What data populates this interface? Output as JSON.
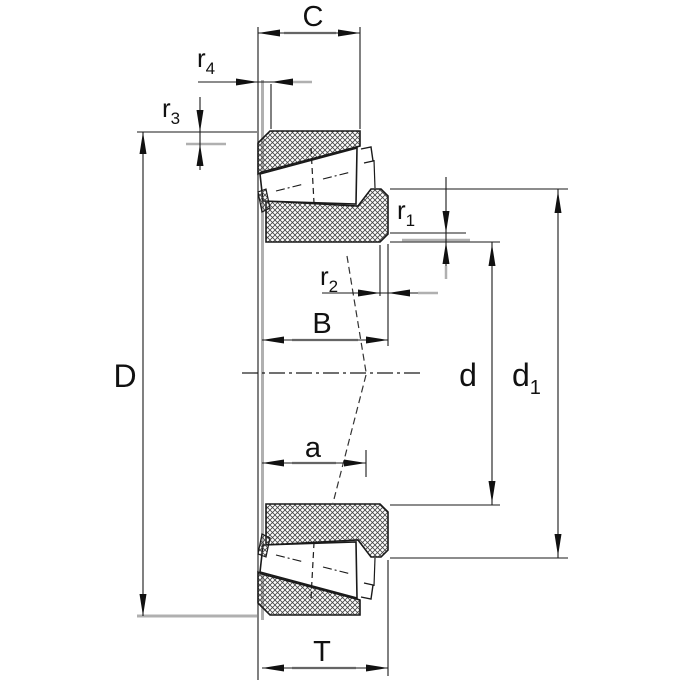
{
  "drawing": {
    "kind": "tapered-roller-bearing-dimension-drawing",
    "labels": {
      "C": "C",
      "D": "D",
      "B": "B",
      "T": "T",
      "a": "a",
      "d": "d",
      "d1": {
        "base": "d",
        "sub": "1"
      },
      "r1": {
        "base": "r",
        "sub": "1"
      },
      "r2": {
        "base": "r",
        "sub": "2"
      },
      "r3": {
        "base": "r",
        "sub": "3"
      },
      "r4": {
        "base": "r",
        "sub": "4"
      }
    },
    "colors": {
      "line": "#1a1a1a",
      "highlight_gray": "#b0b0b0",
      "background": "#ffffff"
    }
  }
}
